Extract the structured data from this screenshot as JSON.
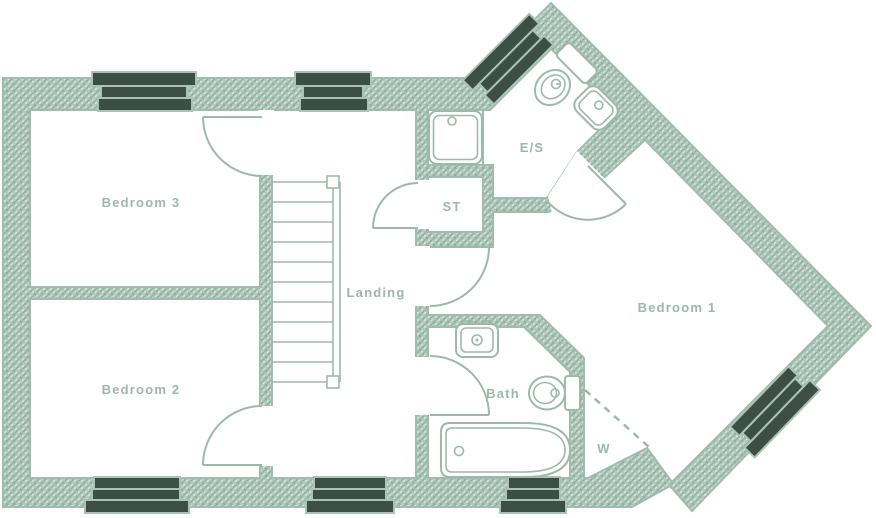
{
  "plan": {
    "kind": "floor-plan",
    "labels": {
      "bedroom3": "Bedroom 3",
      "bedroom2": "Bedroom 2",
      "bedroom1": "Bedroom 1",
      "landing": "Landing",
      "storage": "ST",
      "ensuite": "E/S",
      "bath": "Bath",
      "wardrobe": "W"
    },
    "fixtures": [
      "staircase",
      "shower-tray",
      "toilet",
      "wash-basin",
      "bathtub",
      "wardrobe-dashed-boundary"
    ],
    "window_count": 7,
    "door_count": 6
  },
  "colors": {
    "background": "#ffffff",
    "wall_edge": "#9fbcae",
    "line": "#9cb9ab",
    "text_color": "#9bb8aa",
    "window_dark": "#3d4e44",
    "window_edge": "#a9c3b6",
    "hatch_bg": "#b6cbbf",
    "hatch_line": "#90afa1"
  }
}
